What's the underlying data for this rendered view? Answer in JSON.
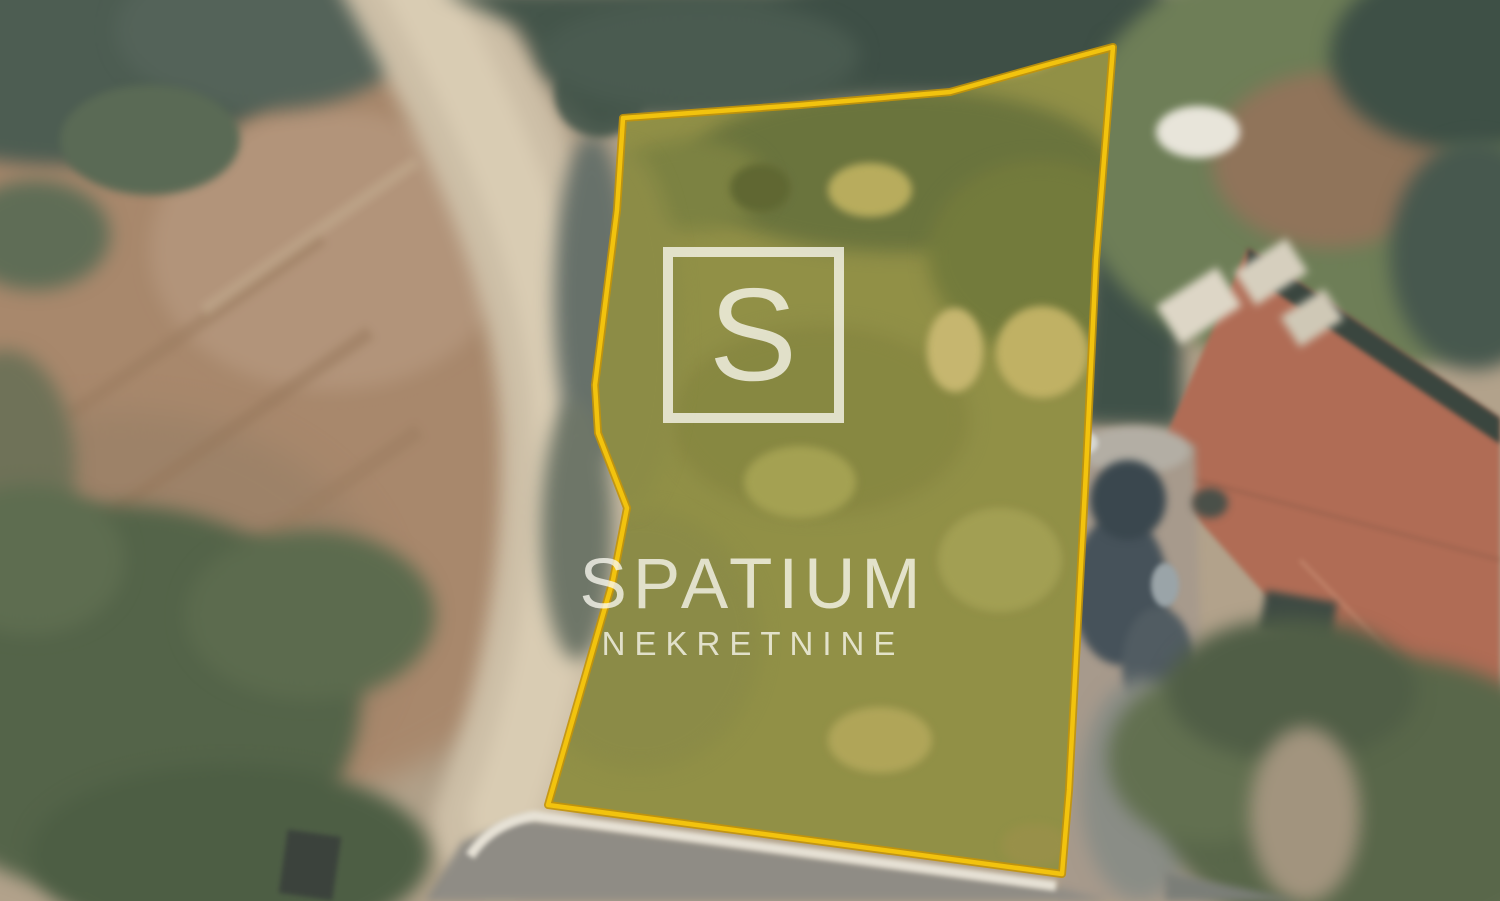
{
  "watermark": {
    "logo_letter": "S",
    "brand": "SPATIUM",
    "subtitle": "NEKRETNINE",
    "color": "rgba(250,249,240,0.78)"
  },
  "parcel": {
    "boundary_color": "#F2C30E",
    "boundary_edge_color": "#C39408",
    "fill_tint": "rgba(252,210,0,0.10)"
  }
}
